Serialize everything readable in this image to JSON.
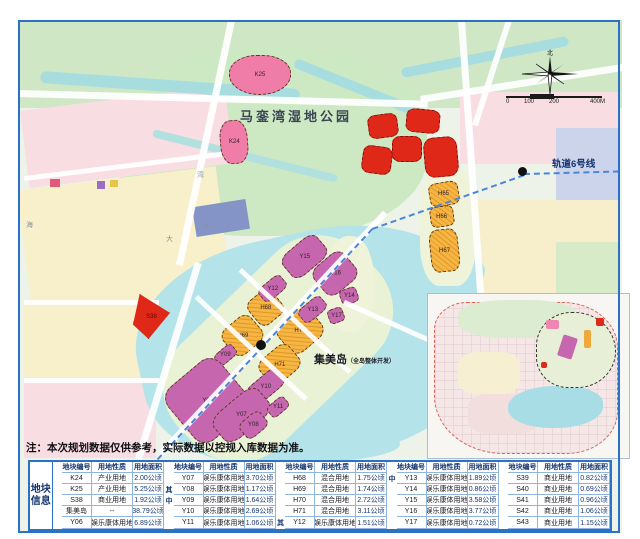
{
  "note": "注：本次规划数据仅供参考，实际数据以控规入库数据为准。",
  "map": {
    "park_label": "马銮湾湿地公园",
    "island_label": "集美岛",
    "island_sublabel": "（全岛整体开发）",
    "rail_label": "轨道6号线",
    "compass_north": "北",
    "scale_ticks": [
      "0",
      "100",
      "200",
      "400M"
    ],
    "road_chars": [
      "湾",
      "道",
      "大",
      "海"
    ]
  },
  "colors": {
    "frame_blue": "#2a72c8",
    "parcel_pink": "#f07ca8",
    "parcel_red": "#e02818",
    "parcel_purple": "#c666ae",
    "parcel_orange": "#f6b545",
    "water": "#b4e4e9",
    "park_green": "#cde9c4",
    "header_text": "#15356e"
  },
  "parcels": [
    {
      "id": "K25",
      "type": "pink"
    },
    {
      "id": "K24",
      "type": "pink"
    },
    {
      "id": "S38",
      "type": "red"
    },
    {
      "id": "",
      "type": "red"
    },
    {
      "id": "",
      "type": "red"
    },
    {
      "id": "",
      "type": "red"
    },
    {
      "id": "",
      "type": "red"
    },
    {
      "id": "",
      "type": "red"
    },
    {
      "id": "H65",
      "type": "orange"
    },
    {
      "id": "H66",
      "type": "orange"
    },
    {
      "id": "H67",
      "type": "orange"
    },
    {
      "id": "H68",
      "type": "orange"
    },
    {
      "id": "H69",
      "type": "orange"
    },
    {
      "id": "H70",
      "type": "orange"
    },
    {
      "id": "H71",
      "type": "orange"
    },
    {
      "id": "Y15",
      "type": "purple"
    },
    {
      "id": "Y16",
      "type": "purple"
    },
    {
      "id": "Y12",
      "type": "purple"
    },
    {
      "id": "Y13",
      "type": "purple"
    },
    {
      "id": "Y14",
      "type": "purple"
    },
    {
      "id": "Y17",
      "type": "purple"
    },
    {
      "id": "Y09",
      "type": "purple"
    },
    {
      "id": "Y10",
      "type": "purple"
    },
    {
      "id": "Y06",
      "type": "purple"
    },
    {
      "id": "Y07",
      "type": "purple"
    },
    {
      "id": "Y08",
      "type": "purple"
    },
    {
      "id": "Y11",
      "type": "purple"
    }
  ],
  "table": {
    "row_header": "地块信息",
    "col_headers": [
      "地块编号",
      "用地性质",
      "用地面积"
    ],
    "groups": [
      {
        "markers": [
          "",
          "",
          "",
          "",
          ""
        ],
        "rows": [
          [
            "K24",
            "产业用地",
            "2.00公顷"
          ],
          [
            "K25",
            "产业用地",
            "5.25公顷"
          ],
          [
            "S38",
            "商业用地",
            "1.92公顷"
          ],
          [
            "集美岛",
            "--",
            "38.79公顷"
          ],
          [
            "Y06",
            "娱乐康体用地",
            "6.89公顷"
          ]
        ]
      },
      {
        "markers": [
          "",
          "其",
          "中",
          "",
          ""
        ],
        "rows": [
          [
            "Y07",
            "娱乐康体用地",
            "3.70公顷"
          ],
          [
            "Y08",
            "娱乐康体用地",
            "1.17公顷"
          ],
          [
            "Y09",
            "娱乐康体用地",
            "1.64公顷"
          ],
          [
            "Y10",
            "娱乐康体用地",
            "2.69公顷"
          ],
          [
            "Y11",
            "娱乐康体用地",
            "1.06公顷"
          ]
        ]
      },
      {
        "markers": [
          "",
          "",
          "",
          "",
          "其"
        ],
        "rows": [
          [
            "H68",
            "混合用地",
            "1.75公顷"
          ],
          [
            "H69",
            "混合用地",
            "1.74公顷"
          ],
          [
            "H70",
            "混合用地",
            "2.72公顷"
          ],
          [
            "H71",
            "混合用地",
            "3.11公顷"
          ],
          [
            "Y12",
            "娱乐康体用地",
            "1.51公顷"
          ]
        ]
      },
      {
        "markers": [
          "中",
          "",
          "",
          "",
          ""
        ],
        "rows": [
          [
            "Y13",
            "娱乐康体用地",
            "1.89公顷"
          ],
          [
            "Y14",
            "娱乐康体用地",
            "0.86公顷"
          ],
          [
            "Y15",
            "娱乐康体用地",
            "3.58公顷"
          ],
          [
            "Y16",
            "娱乐康体用地",
            "3.77公顷"
          ],
          [
            "Y17",
            "娱乐康体用地",
            "0.72公顷"
          ]
        ]
      },
      {
        "markers": [
          "",
          "",
          "",
          "",
          ""
        ],
        "rows": [
          [
            "S39",
            "商业用地",
            "0.82公顷"
          ],
          [
            "S40",
            "商业用地",
            "0.69公顷"
          ],
          [
            "S41",
            "商业用地",
            "0.96公顷"
          ],
          [
            "S42",
            "商业用地",
            "1.06公顷"
          ],
          [
            "S43",
            "商业用地",
            "1.15公顷"
          ]
        ]
      }
    ]
  }
}
